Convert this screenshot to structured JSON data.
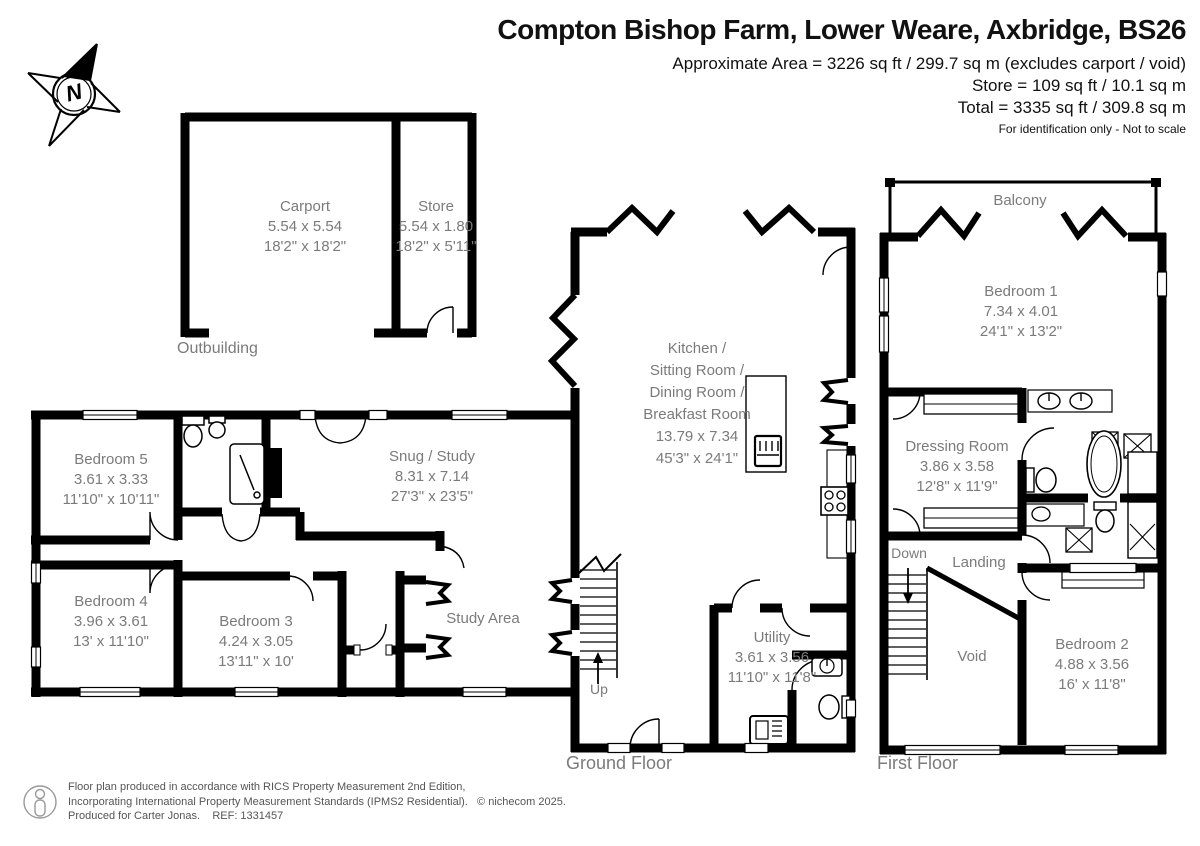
{
  "header": {
    "title": "Compton Bishop Farm, Lower Weare, Axbridge, BS26",
    "area_line1": "Approximate Area = 3226 sq ft / 299.7 sq m (excludes carport / void)",
    "area_line2": "Store = 109 sq ft / 10.1 sq m",
    "area_line3": "Total = 3335 sq ft / 309.8 sq m",
    "disclaimer": "For identification only - Not to scale"
  },
  "compass": {
    "letter": "N"
  },
  "floors": {
    "outbuilding": "Outbuilding",
    "ground": "Ground Floor",
    "first": "First Floor"
  },
  "rooms": {
    "carport": {
      "name": "Carport",
      "metric": "5.54 x 5.54",
      "imperial": "18'2\" x 18'2\""
    },
    "store": {
      "name": "Store",
      "metric": "5.54 x 1.80",
      "imperial": "18'2\" x 5'11\""
    },
    "bedroom5": {
      "name": "Bedroom 5",
      "metric": "3.61 x 3.33",
      "imperial": "11'10\" x 10'11\""
    },
    "bedroom4": {
      "name": "Bedroom 4",
      "metric": "3.96 x 3.61",
      "imperial": "13' x 11'10\""
    },
    "bedroom3": {
      "name": "Bedroom 3",
      "metric": "4.24 x 3.05",
      "imperial": "13'11\" x 10'"
    },
    "snug": {
      "name": "Snug / Study",
      "metric": "8.31 x 7.14",
      "imperial": "27'3\" x 23'5\""
    },
    "study_area": {
      "name": "Study Area"
    },
    "kitchen": {
      "line1": "Kitchen /",
      "line2": "Sitting Room /",
      "line3": "Dining Room /",
      "line4": "Breakfast Room",
      "metric": "13.79 x 7.34",
      "imperial": "45'3\" x 24'1\""
    },
    "utility": {
      "name": "Utility",
      "metric": "3.61 x 3.56",
      "imperial": "11'10\" x 11'8\""
    },
    "bedroom1": {
      "name": "Bedroom 1",
      "metric": "7.34 x 4.01",
      "imperial": "24'1\" x 13'2\""
    },
    "dressing": {
      "name": "Dressing Room",
      "metric": "3.86 x 3.58",
      "imperial": "12'8\" x 11'9\""
    },
    "bedroom2": {
      "name": "Bedroom 2",
      "metric": "4.88 x 3.56",
      "imperial": "16' x 11'8\""
    },
    "balcony": {
      "name": "Balcony"
    },
    "landing": {
      "name": "Landing"
    },
    "void": {
      "name": "Void"
    }
  },
  "stairs": {
    "up": "Up",
    "down": "Down"
  },
  "footer": {
    "line1": "Floor plan produced in accordance with RICS Property Measurement 2nd Edition,",
    "line2": "Incorporating International Property Measurement Standards (IPMS2 Residential).",
    "copyright": "© nichecom 2025.",
    "line3": "Produced for Carter Jonas.",
    "ref": "REF: 1331457"
  },
  "colors": {
    "wall": "#000000",
    "label": "#7b7b7b"
  }
}
